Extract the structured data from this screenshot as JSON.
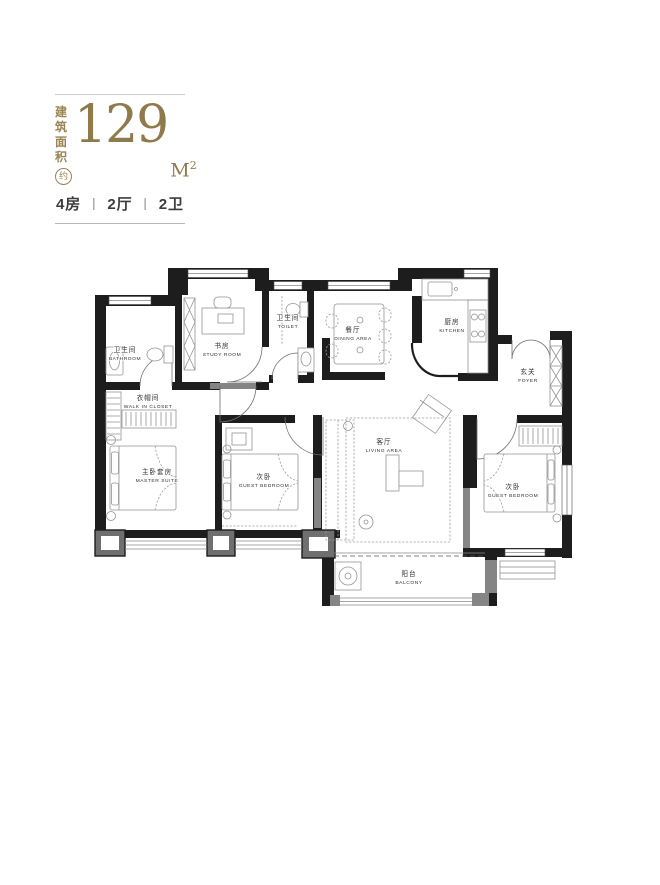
{
  "header": {
    "area_label_line1": "建筑",
    "area_label_line2": "面积",
    "approx": "约",
    "area_value": "129",
    "area_unit": "M",
    "area_unit_sup": "2",
    "separator": "丨",
    "units": [
      "4房",
      "2厅",
      "2卫"
    ]
  },
  "floorplan": {
    "rooms": [
      {
        "id": "bathroom",
        "cn": "卫生间",
        "en": "BATHROOM"
      },
      {
        "id": "study-room",
        "cn": "书房",
        "en": "STUDY ROOM"
      },
      {
        "id": "toilet",
        "cn": "卫生间",
        "en": "TOILET"
      },
      {
        "id": "dining-area",
        "cn": "餐厅",
        "en": "DINING AREA"
      },
      {
        "id": "kitchen",
        "cn": "厨房",
        "en": "KITCHEN"
      },
      {
        "id": "foyer",
        "cn": "玄关",
        "en": "FOYER"
      },
      {
        "id": "walk-in-closet",
        "cn": "衣帽间",
        "en": "WALK IN CLOSET"
      },
      {
        "id": "master-suite",
        "cn": "主卧套房",
        "en": "MASTER SUITE"
      },
      {
        "id": "guest-bedroom-mid",
        "cn": "次卧",
        "en": "GUEST BEDROOM"
      },
      {
        "id": "living-area",
        "cn": "客厅",
        "en": "LIVING AREA"
      },
      {
        "id": "guest-bedroom-right",
        "cn": "次卧",
        "en": "GUEST BEDROOM"
      },
      {
        "id": "balcony",
        "cn": "阳台",
        "en": "BALCONY"
      }
    ]
  },
  "colors": {
    "gold": "#9a8455",
    "digit_gold": "#8f7a4b",
    "text_dark": "#3d3d3d",
    "wall": "#1d1d1d"
  }
}
